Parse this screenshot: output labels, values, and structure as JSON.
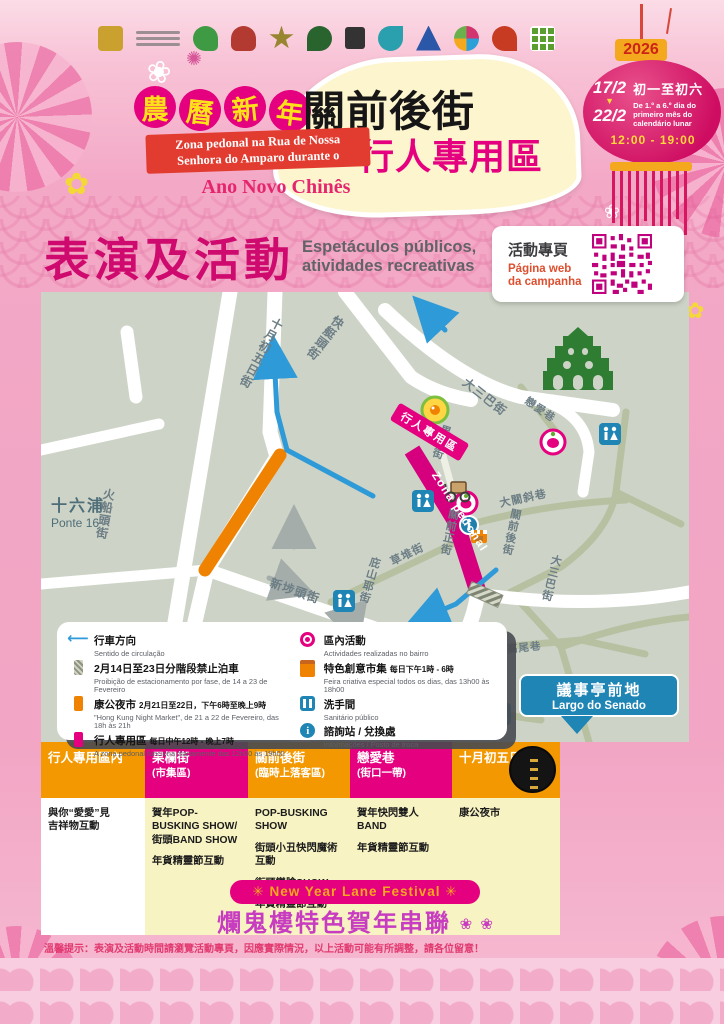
{
  "palette": {
    "magenta": "#e4007f",
    "deep_magenta": "#cf0a6e",
    "orange": "#f39800",
    "night_market_orange": "#ef8200",
    "lantern_red": "#ce0c61",
    "ribbon_red": "#e23c30",
    "year_gold": "#f3a81d",
    "map_bg": "#cdd3c6",
    "map_blue": "#1f85b5",
    "route_blue": "#2f9ad8",
    "ruins_green": "#2e7d32",
    "table_yellow": "#f7f3c2",
    "logo_colors": [
      "#caa02e",
      "#3f9a44",
      "#b23a30",
      "#97862f",
      "#29632e",
      "#333333",
      "#2a9fae",
      "#2b57a8",
      "#d2356f",
      "#c63b22",
      "#5a9e2f"
    ]
  },
  "header": {
    "year_badge": "2026"
  },
  "title": {
    "zh_badge_chars": [
      "農",
      "曆",
      "新",
      "年"
    ],
    "zh_street": "關前後街",
    "zh_pedestrian": "行人專用區",
    "ribbon_line1": "Zona pedonal na Rua de Nossa",
    "ribbon_line2": "Senhora do Amparo durante o",
    "highlight": "Ano Novo Chinês"
  },
  "lantern": {
    "date_start": "17/2",
    "date_end": "22/2",
    "zh_days": "初一至初六",
    "pt_days": "De 1.º a 6.º dia do primeiro mês do calendário lunar",
    "hours": "12:00 - 19:00"
  },
  "section": {
    "zh": "表演及活動",
    "pt": "Espetáculos públicos,\natividades recreativas"
  },
  "qr": {
    "zh": "活動專頁",
    "pt": "Página web\nda campanha"
  },
  "map": {
    "ponte16_zh": "十六浦",
    "ponte16_pt": "Ponte 16",
    "senado_zh": "議事亭前地",
    "senado_pt": "Largo do Senado",
    "flag": "行人專用區",
    "zona": "Zona pedonal",
    "streets": {
      "oct5": "十月初五日街",
      "faiteng": "快艇頭街",
      "foshantau": "火船頭街",
      "sanbutau": "新埗頭街",
      "pishanye": "庇山耶街",
      "caodui": "草堆街",
      "guolan": "果欄街",
      "guanqianzheng": "關前正街",
      "guanqianhou": "關前後街",
      "daguanxie": "大關斜巷",
      "dasanba_upper": "大三巴街",
      "lianai": "戀愛巷",
      "dasanba_lower": "大三巴街",
      "yingdi": "營地大街",
      "gaowei": "高尾巷"
    }
  },
  "legend": {
    "items_left": [
      {
        "zh": "行車方向",
        "detail": "",
        "pt": "Sentido de circulação"
      },
      {
        "zh": "2月14日至23日分階段禁止泊車",
        "detail": "",
        "pt": "Proibição de estacionamento por fase, de 14 a 23 de Fevereiro"
      },
      {
        "zh": "康公夜市",
        "detail": "2月21日至22日，下午6時至晚上9時",
        "pt": "\"Hong Kung Night Market\", de 21 a 22 de Fevereiro, das 18h às 21h"
      },
      {
        "zh": "行人專用區",
        "detail": "每日中午12時 - 晚上7時",
        "pt": "A zona pedonal funciona diariamente das 12h00 às 19h00"
      }
    ],
    "items_right": [
      {
        "zh": "區內活動",
        "detail": "",
        "pt": "Actividades realizadas no bairro"
      },
      {
        "zh": "特色創意市集",
        "detail": "每日下午1時 - 6時",
        "pt": "Feira criativa especial todos os dias, das 13h00 às 18h00"
      },
      {
        "zh": "洗手間",
        "detail": "",
        "pt": "Sanitário público"
      },
      {
        "zh": "諮詢站 / 兌換處",
        "detail": "",
        "pt": "Informações / Posto de troca"
      }
    ]
  },
  "table": {
    "columns": [
      {
        "header": "行人專用區內",
        "sub": "",
        "items": [
          "與你“愛愛”見\n吉祥物互動"
        ]
      },
      {
        "header": "果欄街",
        "sub": "(市集區)",
        "items": [
          "賀年POP-BUSKING SHOW/\n街頭BAND SHOW",
          "年貨精靈節互動"
        ]
      },
      {
        "header": "關前後街",
        "sub": "(臨時上落客區)",
        "items": [
          "POP-BUSKING SHOW",
          "街頭小丑快閃魔術互動",
          "街頭變臉SHOW",
          "年貨精靈節互動"
        ]
      },
      {
        "header": "戀愛巷",
        "sub": "(街口一帶)",
        "items": [
          "賀年快閃雙人BAND",
          "年貨精靈節互動"
        ]
      },
      {
        "header": "十月初五日街",
        "sub": "",
        "items": [
          "康公夜市"
        ]
      }
    ],
    "banner_en": "✳  New Year Lane Festival  ✳",
    "banner_zh": "爛鬼樓特色賀年串聯",
    "banner_deco": "❀ ❀"
  },
  "footer": {
    "note": "溫馨提示：表演及活動時間請瀏覽活動專頁，因應實際情況，以上活動可能有所調整，請各位留意！"
  }
}
